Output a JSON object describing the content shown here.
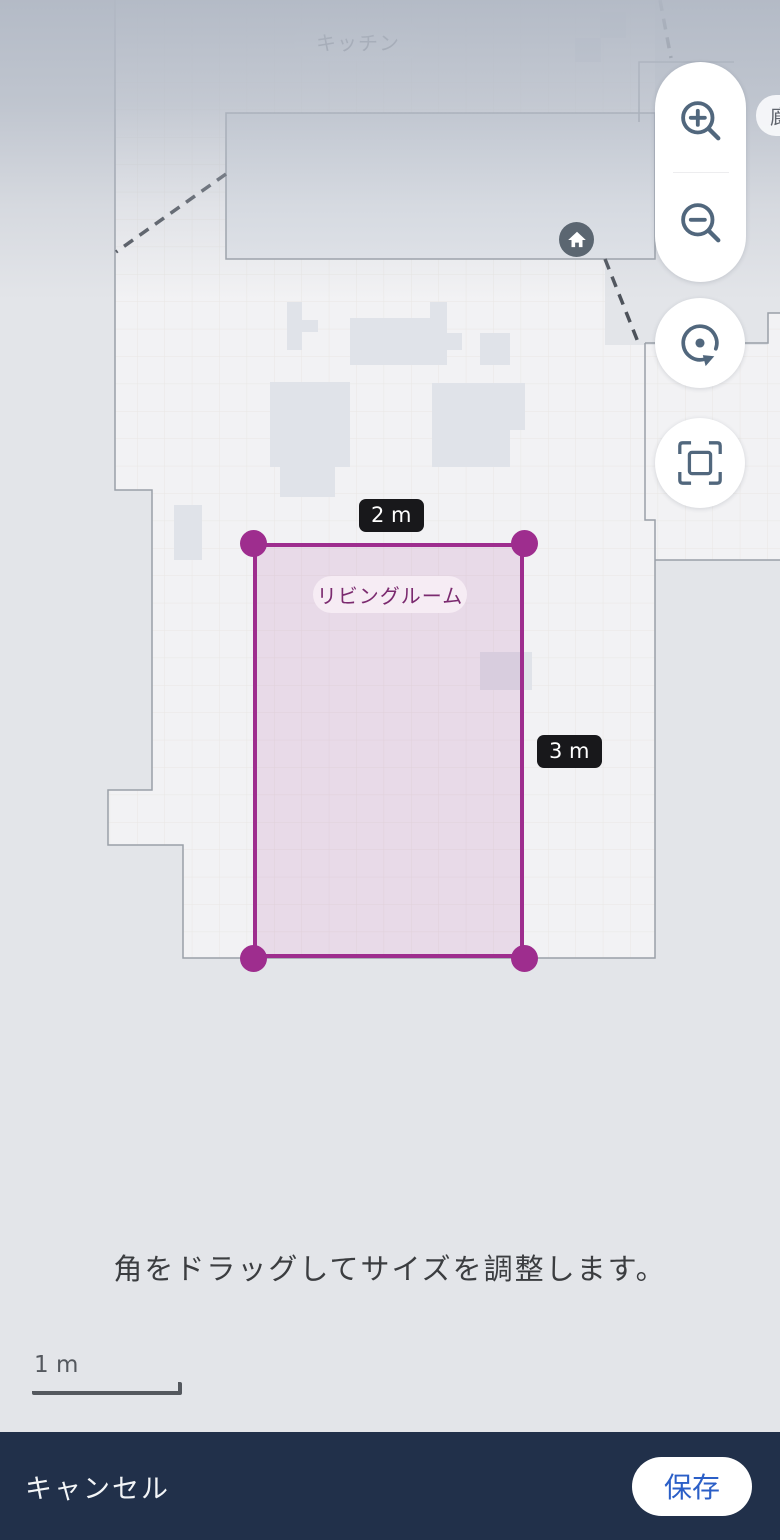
{
  "map": {
    "kitchen_label": "キッチン",
    "hallway_label": "廊下",
    "room_label": "リビングルーム",
    "width_label": "2 m",
    "height_label": "3 m"
  },
  "instruction": "角をドラッグしてサイズを調整します。",
  "scale_label": "1 m",
  "footer": {
    "cancel": "キャンセル",
    "save": "保存"
  },
  "colors": {
    "accent_purple": "#9e2d8e",
    "selection_fill": "rgba(162,48,144,0.12)",
    "control_icon": "#51677d",
    "badge_bg": "#18181b",
    "bottom_bar": "#21304a",
    "save_text": "#2b5fc7",
    "floor": "#f2f2f4",
    "background": "#e3e5e9"
  }
}
